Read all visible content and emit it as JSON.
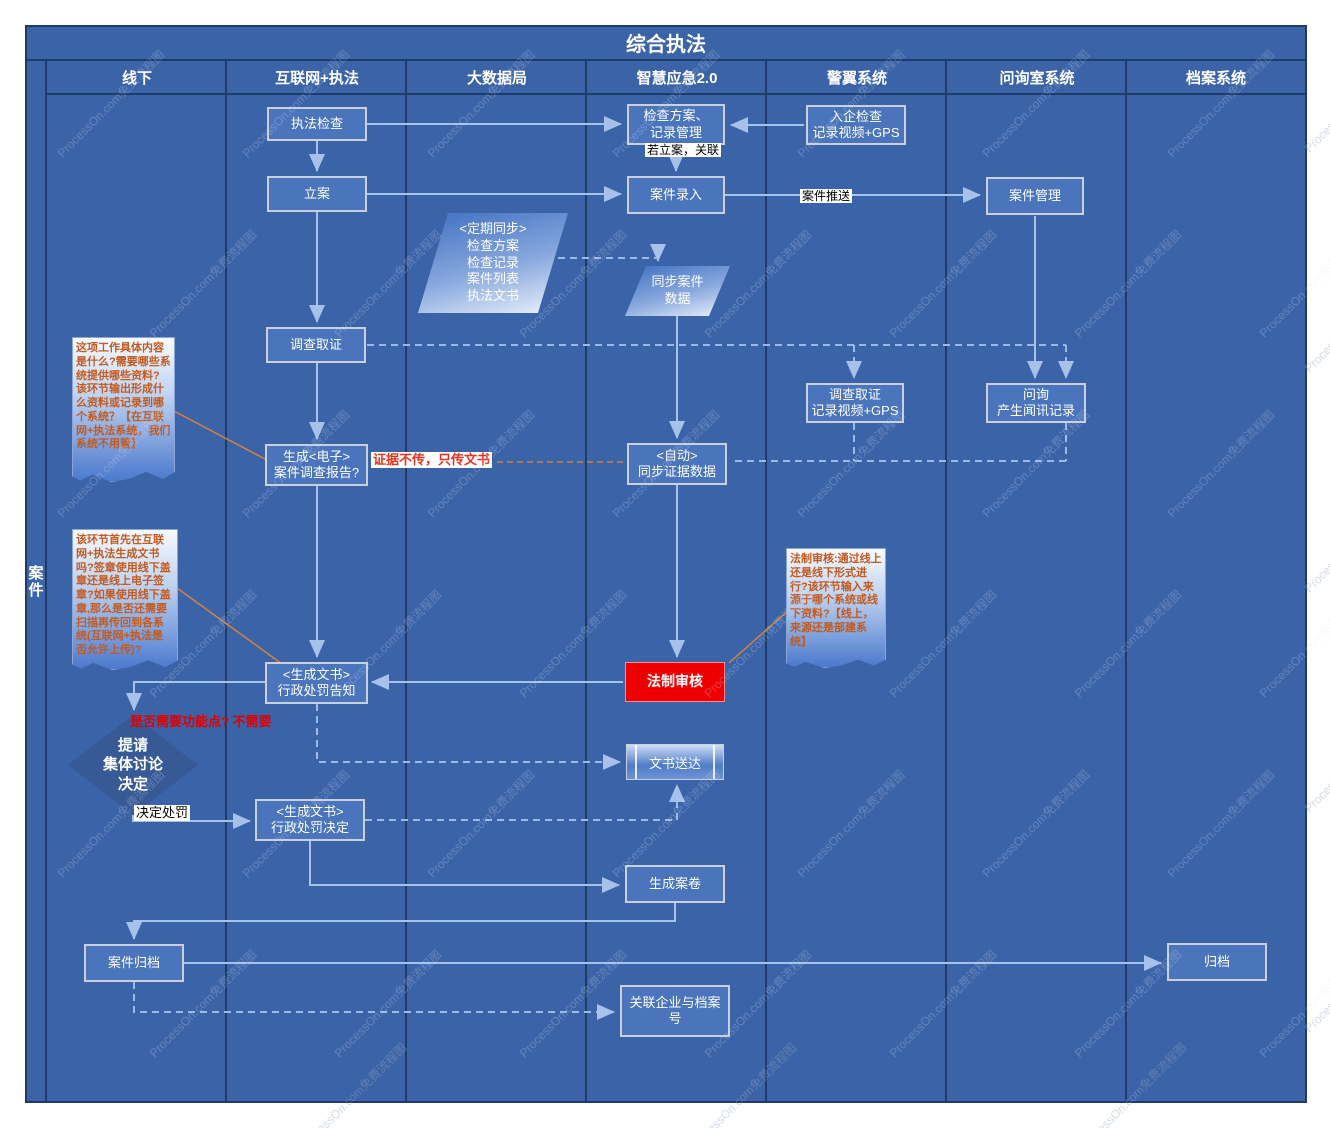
{
  "title": "综合执法",
  "stage_label": "案件",
  "watermark": {
    "text": "ProcessOn.com免费流程图"
  },
  "lanes": [
    {
      "label": "线下"
    },
    {
      "label": "互联网+执法"
    },
    {
      "label": "大数据局"
    },
    {
      "label": "智慧应急2.0"
    },
    {
      "label": "警翼系统"
    },
    {
      "label": "问询室系统"
    },
    {
      "label": "档案系统"
    }
  ],
  "nodes": {
    "zhifa_jiancha": "执法检查",
    "li_an": "立案",
    "jiancha_fangan": "检查方案、\n记录管理",
    "anjian_luru": "案件录入",
    "ruqi_jiancha": "入企检查\n记录视频+GPS",
    "anjian_guanli": "案件管理",
    "dingqi_tongbu": "<定期同步>\n检查方案\n检查记录\n案件列表\n执法文书",
    "tongbu_anjian": "同步案件\n数据",
    "diaocha_quzheng": "调查取证",
    "shengcheng_dianzi": "生成<电子>\n案件调查报告?",
    "zidong_tongbu": "<自动>\n同步证据数据",
    "diaocha_gps": "调查取证\n记录视频+GPS",
    "wenxun": "问询\n产生闻讯记录",
    "xingzheng_gaozhi": "<生成文书>\n行政处罚告知",
    "fazhi_shenhe": "法制审核",
    "tiqing_jueding": "提请\n集体讨论\n决定",
    "xingzheng_jueding": "<生成文书>\n行政处罚决定",
    "wenshu_songda": "文书送达",
    "shengcheng_anjuan": "生成案卷",
    "anjian_guidang": "案件归档",
    "guidang": "归档",
    "guanlian_qiye": "关联企业与档案\n号"
  },
  "labels": {
    "ruo_lian": "若立案，关联",
    "anjian_tuisong": "案件推送",
    "zhengju_buchuan": "证据不传，只传文书",
    "xuyao_gongneng": "是否需要功能点? 不需要",
    "jueding_chufa": "决定处罚"
  },
  "notes": {
    "note1": "这项工作具体内容是什么?需要哪些系统提供哪些资料?\n该环节输出形成什么资料或记录到哪个系统？【在互联网+执法系统，我们系统不用管】",
    "note2": "该环节首先在互联网+执法生成文书吗?签章使用线下盖章还是线上电子签章?如果使用线下盖章,那么是否还需要扫描再传回到各系统(互联网+执法是否允许上传)?",
    "note3": "法制审核:通过线上还是线下形式进行?该环节输入来源于哪个系统或线下资料?【线上，来源还是部建系统】"
  },
  "colors": {
    "pool_background": "#3b63a7",
    "lane_border": "#1f3b69",
    "node_fill": "#4a75bc",
    "node_border": "#c9d0dc",
    "legal_review_red": "#ee0000",
    "note_text_orange": "#c35a1e",
    "connector_blue": "#a6c2ea",
    "connector_orange": "#d8813f",
    "label_red": "#e8321e"
  }
}
